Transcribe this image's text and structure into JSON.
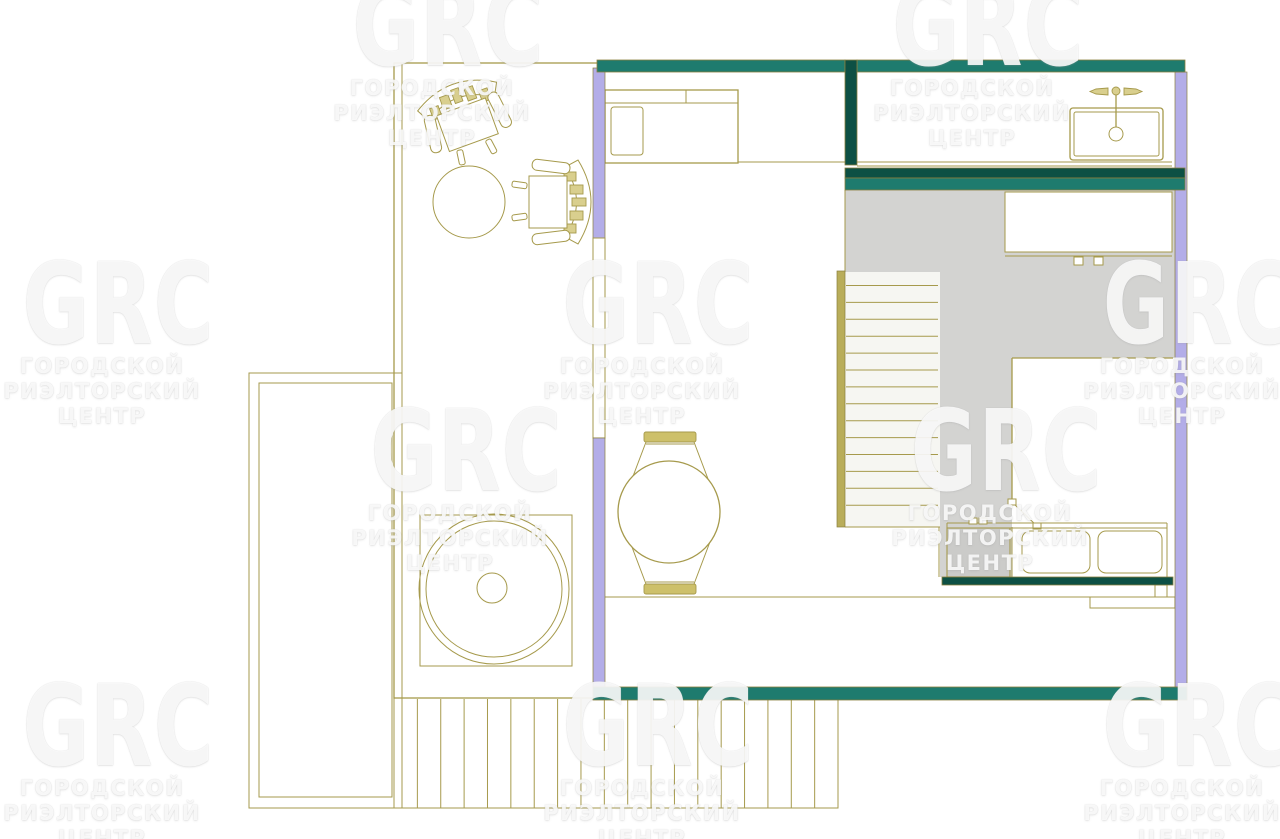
{
  "watermark": {
    "logo": "GRC",
    "lines": [
      "ГОРОДСКОЙ",
      "РИЭЛТОРСКИЙ",
      "ЦЕНТР"
    ],
    "tiles": [
      {
        "x": 322,
        "y": -20
      },
      {
        "x": 862,
        "y": -20
      },
      {
        "x": -8,
        "y": 258
      },
      {
        "x": 532,
        "y": 258
      },
      {
        "x": 1072,
        "y": 258
      },
      {
        "x": 340,
        "y": 405
      },
      {
        "x": 880,
        "y": 405
      },
      {
        "x": -8,
        "y": 680
      },
      {
        "x": 532,
        "y": 680
      },
      {
        "x": 1072,
        "y": 680
      }
    ]
  },
  "colors": {
    "background": "#ffffff",
    "gold_line": "#a69a4c",
    "gold_dark": "#8a7f3e",
    "teal_medium": "#1e7b6e",
    "teal_dark": "#0d5044",
    "lavender": "#b3ade8",
    "floor_gray": "#d3d3d1",
    "counter_gray": "#cbcbc9",
    "tread_white": "#f6f6f2",
    "rail_gold": "#b9ad5a",
    "furniture_fill": "#d9cf8e",
    "chair_bar": "#cdc06a"
  },
  "plan": {
    "stairs": {
      "tread_lines": 14
    },
    "deck": {
      "planks": 18
    },
    "features": [
      "balcony",
      "lounge-room",
      "armchair",
      "side-chair",
      "coffee-table",
      "jacuzzi",
      "terrace-deck",
      "living-room",
      "bed",
      "dining-table",
      "dining-chairs",
      "bathroom",
      "bathroom-sink",
      "hallway",
      "staircase",
      "wardrobe",
      "bedroom",
      "door-swing",
      "kitchen-counter",
      "window-strips"
    ]
  }
}
